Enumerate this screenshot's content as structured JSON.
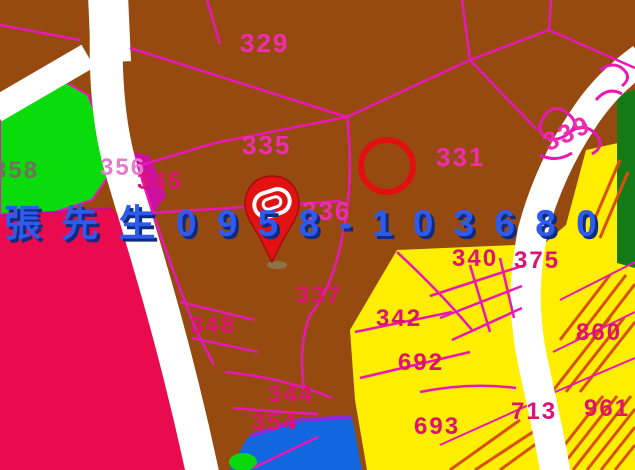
{
  "map": {
    "title": "cadastral-parcel-map",
    "watermark": {
      "text": "張 先 生 0 9 5 8 - 1 0 3 6 8 0",
      "contact_name": "張先生",
      "phone": "0958-103680",
      "color": "#2E5BEE"
    },
    "parcel_labels": [
      {
        "text": "329"
      },
      {
        "text": "335"
      },
      {
        "text": "331"
      },
      {
        "text": "339"
      },
      {
        "text": "336"
      },
      {
        "text": "345"
      },
      {
        "text": "356"
      },
      {
        "text": "358"
      },
      {
        "text": "337"
      },
      {
        "text": "348"
      },
      {
        "text": "344"
      },
      {
        "text": "354"
      },
      {
        "text": "340"
      },
      {
        "text": "375"
      },
      {
        "text": "342"
      },
      {
        "text": "692"
      },
      {
        "text": "693"
      },
      {
        "text": "860"
      },
      {
        "text": "961"
      },
      {
        "text": "713"
      }
    ],
    "annotations": {
      "highlight_circle": "red outline circle on parcel 331",
      "marker": "red location pin with white oval emblem"
    },
    "colors": {
      "land_brown": "#964A10",
      "parcel_line_magenta": "#E818B8",
      "road_white": "#FFFFFF",
      "green_zone": "#0ADB0A",
      "dark_green_zone": "#157A15",
      "red_zone": "#E90B4E",
      "yellow_zone": "#FFEE00",
      "blue_zone": "#1367DE",
      "hatch_orange": "#D8500F",
      "label_pink": "#F02DB0",
      "label_deep_pink": "#DE1272",
      "label_gray": "#72715F",
      "watermark_blue": "#2E5BEE",
      "circle_red": "#E01010",
      "pin_red": "#E31212"
    }
  }
}
